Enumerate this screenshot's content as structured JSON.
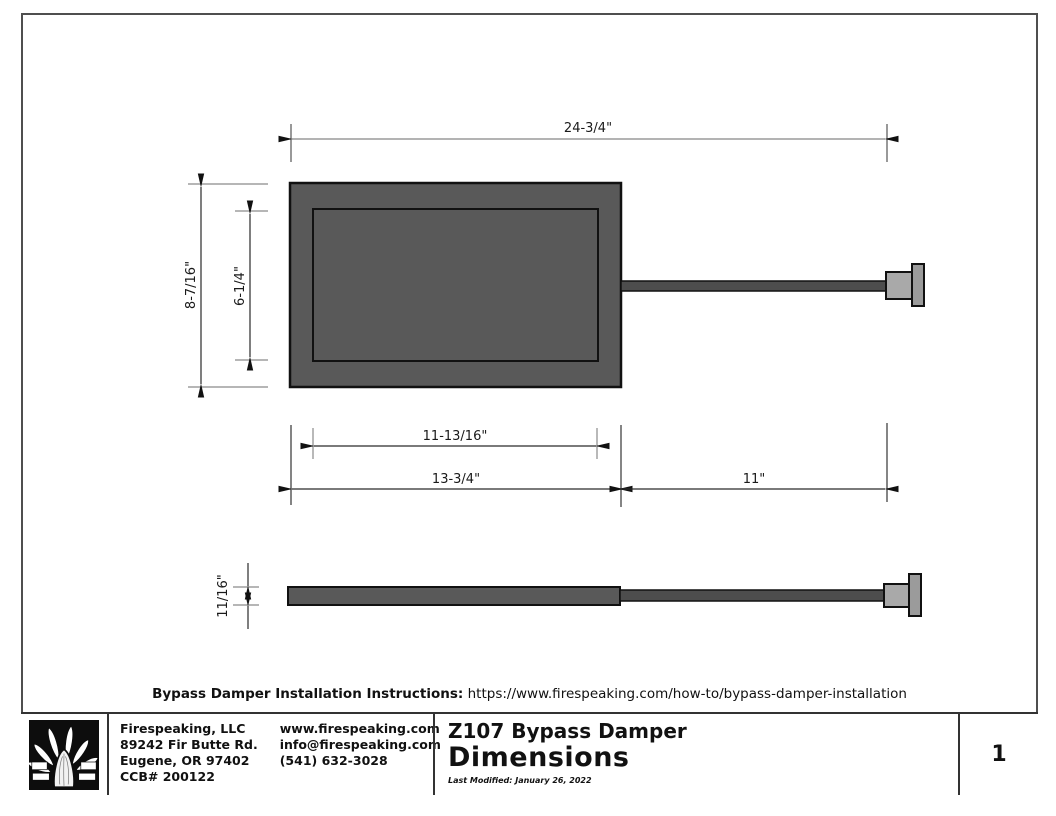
{
  "drawing": {
    "dims": {
      "top_width": "24-3/4\"",
      "outer_height": "8-7/16\"",
      "inner_height": "6-1/4\"",
      "inner_width": "11-13/16\"",
      "plate_width": "13-3/4\"",
      "rod_length": "11\"",
      "thickness": "11/16\""
    },
    "note": {
      "label": "Bypass Damper Installation Instructions:",
      "url": " https://www.firespeaking.com/how-to/bypass-damper-installation"
    }
  },
  "title_block": {
    "company": {
      "name": "Firespeaking, LLC",
      "address1": "89242 Fir Butte Rd.",
      "address2": "Eugene, OR 97402",
      "ccb": "CCB# 200122"
    },
    "contact": {
      "website": "www.firespeaking.com",
      "email": "info@firespeaking.com",
      "phone": "(541) 632-3028"
    },
    "title": {
      "product": "Z107 Bypass Damper",
      "sheet": "Dimensions",
      "modified": "Last Modified: January 26, 2022"
    },
    "page_number": "1"
  },
  "colors": {
    "plate": "#595959",
    "rod": "#4d4d4d",
    "knob": "#a9a9a9",
    "flange": "#9b9b9b",
    "line": "#1a1a1a",
    "dimline": "#2a2a2a",
    "extline": "#8a8a8a"
  }
}
